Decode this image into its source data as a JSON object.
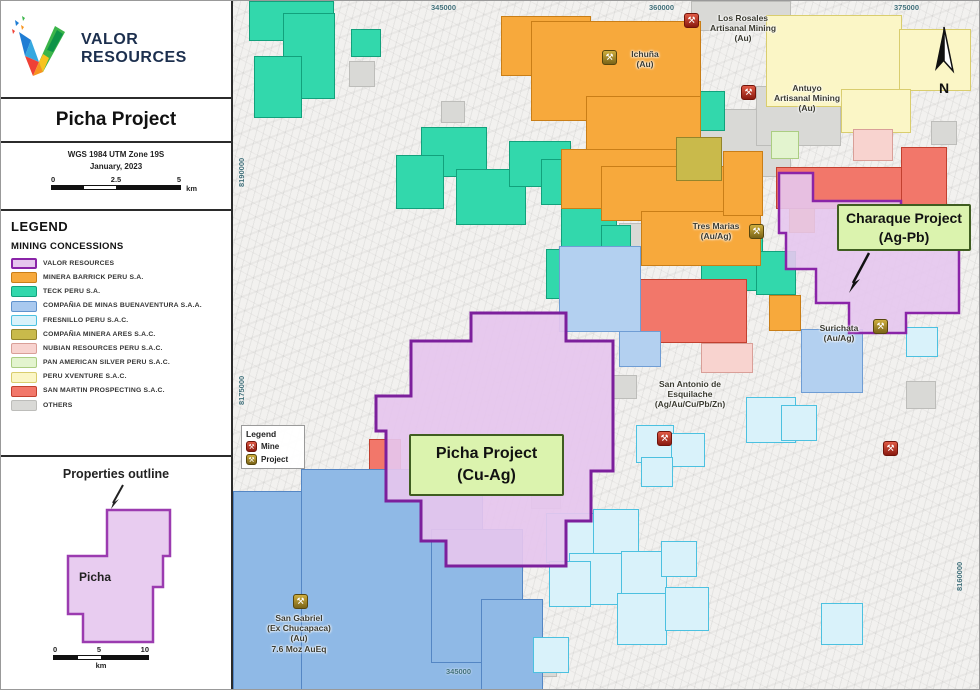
{
  "palette": {
    "valor": {
      "fill": "#e6c6ee",
      "border": "#8a24a8"
    },
    "teck": {
      "fill": "#32d8ac",
      "border": "#12a17c"
    },
    "barrick": {
      "fill": "#f7a93c",
      "border": "#c97e17"
    },
    "xventure": {
      "fill": "#fbf6c6",
      "border": "#d9cd6e"
    },
    "others": {
      "fill": "#d9d9d6",
      "border": "#bdbdba"
    },
    "sanmartin": {
      "fill": "#f2776a",
      "border": "#c2402f"
    },
    "nubian": {
      "fill": "#f8d3cf",
      "border": "#d99f98"
    },
    "buena": {
      "fill": "#8fb9e6",
      "border": "#5486c4"
    },
    "buenal": {
      "fill": "#b3d0f0",
      "border": "#6f9dd4"
    },
    "fresnillo": {
      "fill": "#d9f2fa",
      "border": "#4cc1e0"
    },
    "ares": {
      "fill": "#c9ba4b",
      "border": "#94852b"
    },
    "panam": {
      "fill": "#e3f4cf",
      "border": "#abcd82"
    },
    "labelbox": {
      "fill": "#dbf3ae",
      "border": "#3f5d20"
    }
  },
  "panel": {
    "brand": {
      "line1": "VALOR",
      "line2": "RESOURCES"
    },
    "title": "Picha Project",
    "projection": {
      "line1": "WGS 1984 UTM Zone 19S",
      "line2": "January, 2023"
    },
    "scale": {
      "start": "0",
      "mid": "2.5",
      "end": "5",
      "unit": "km"
    },
    "legend": {
      "heading": "LEGEND",
      "subheading": "MINING CONCESSIONS",
      "items": [
        {
          "label": "VALOR RESOURCES",
          "color": "#e6c6ee",
          "border": "#8a24a8",
          "thick": true
        },
        {
          "label": "MINERA BARRICK PERU S.A.",
          "color": "#f7a93c",
          "border": "#c97e17"
        },
        {
          "label": "TECK PERU S.A.",
          "color": "#32d8ac",
          "border": "#12a17c"
        },
        {
          "label": "COMPAÑIA DE MINAS BUENAVENTURA S.A.A.",
          "color": "#a9c9ef",
          "border": "#5f92cd"
        },
        {
          "label": "FRESNILLO PERU S.A.C.",
          "color": "#d9f2fa",
          "border": "#4cc1e0"
        },
        {
          "label": "COMPAÑIA MINERA ARES S.A.C.",
          "color": "#c9ba4b",
          "border": "#94852b"
        },
        {
          "label": "NUBIAN RESOURCES PERU S.A.C.",
          "color": "#f8d3cf",
          "border": "#d99f98"
        },
        {
          "label": "PAN AMERICAN SILVER PERU S.A.C.",
          "color": "#e3f4cf",
          "border": "#abcd82"
        },
        {
          "label": "PERU XVENTURE S.A.C.",
          "color": "#fbf6c6",
          "border": "#d9cd6e"
        },
        {
          "label": "SAN MARTIN PROSPECTING S.A.C.",
          "color": "#f2776a",
          "border": "#c2402f"
        },
        {
          "label": "OTHERS",
          "color": "#d9d9d6",
          "border": "#bdbdba"
        }
      ]
    },
    "inset": {
      "caption": "Properties outline",
      "polygon_label": "Picha",
      "scale": {
        "start": "0",
        "mid": "5",
        "end": "10",
        "unit": "km"
      }
    }
  },
  "map": {
    "north_label": "N",
    "coordinates": {
      "top": [
        "345000",
        "360000",
        "375000"
      ],
      "bottom": [
        "345000"
      ],
      "left": [
        "8190000",
        "8175000"
      ],
      "right": [
        "8160000"
      ]
    },
    "mini_legend": {
      "title": "Legend",
      "mine": "Mine",
      "project": "Project"
    },
    "labels": {
      "los_rosales": {
        "lines": [
          "Los Rosales",
          "Artisanal Mining",
          "(Au)"
        ]
      },
      "antuyo": {
        "lines": [
          "Antuyo",
          "Artisanal Mining",
          "(Au)"
        ]
      },
      "ichuna": {
        "lines": [
          "Ichuña",
          "(Au)"
        ]
      },
      "tres_marias": {
        "lines": [
          "Tres Marias",
          "(Au/Ag)"
        ]
      },
      "surichata": {
        "lines": [
          "Surichata",
          "(Au/Ag)"
        ]
      },
      "san_antonio": {
        "lines": [
          "San Antonio de",
          "Esquilache",
          "(Ag/Au/Cu/Pb/Zn)"
        ]
      },
      "san_gabriel": {
        "lines": [
          "San Gabriel",
          "(Ex Chucapaca)",
          "(Au)",
          "7.6 Moz AuEq"
        ]
      }
    },
    "project_boxes": {
      "picha": {
        "lines": [
          "Picha Project",
          "(Cu-Ag)"
        ]
      },
      "charaque": {
        "lines": [
          "Charaque Project",
          "(Ag-Pb)"
        ]
      }
    }
  }
}
